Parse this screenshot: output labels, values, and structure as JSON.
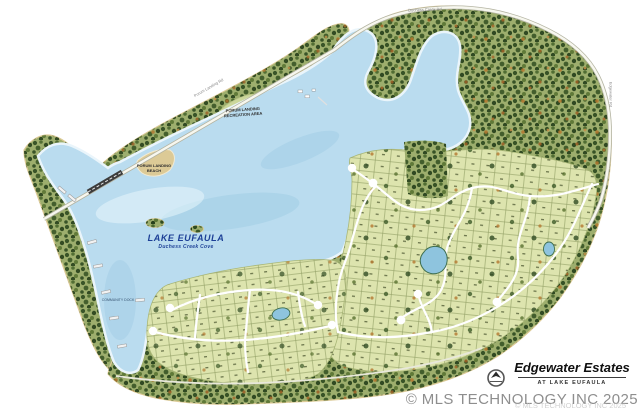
{
  "branding": {
    "logo_icon": "compass-sail-icon",
    "title": "Edgewater Estates",
    "subtitle": "AT LAKE EUFAULA"
  },
  "watermark": {
    "text": "© MLS TECHNOLOGY INC 2025",
    "echo_text": "© MLS TECHNOLOGY INC 2025"
  },
  "labels": {
    "lake": "LAKE EUFAULA",
    "lake_sub": "Duchess Creek Cove",
    "recreation_line1": "PORUM LANDING",
    "recreation_line2": "RECREATION AREA",
    "beach_line1": "PORUM LANDING",
    "beach_line2": "BEACH",
    "road_top": "Duchess Creek Rd",
    "road_diag": "Porum Landing Rd",
    "road_right": "Edgewater Rd",
    "dock": "COMMUNITY DOCK"
  },
  "colors": {
    "page": "#ffffff",
    "lake": "#badcef",
    "lake_streak": "#8fc3de",
    "lake_light": "#e8f6fc",
    "land_base": "#9dae6d",
    "lot_base": "#dde4ae",
    "clearing": "#ccd79b",
    "sand": "#dcca96",
    "road": "#f7f7ef",
    "road_casing": "#b4b4a2",
    "bridge": "#3c3c3c",
    "pond": "#8ec4de",
    "label_blue": "#1c3f96",
    "title_text": "#101010",
    "watermark_gray": "#8e8e8e"
  }
}
